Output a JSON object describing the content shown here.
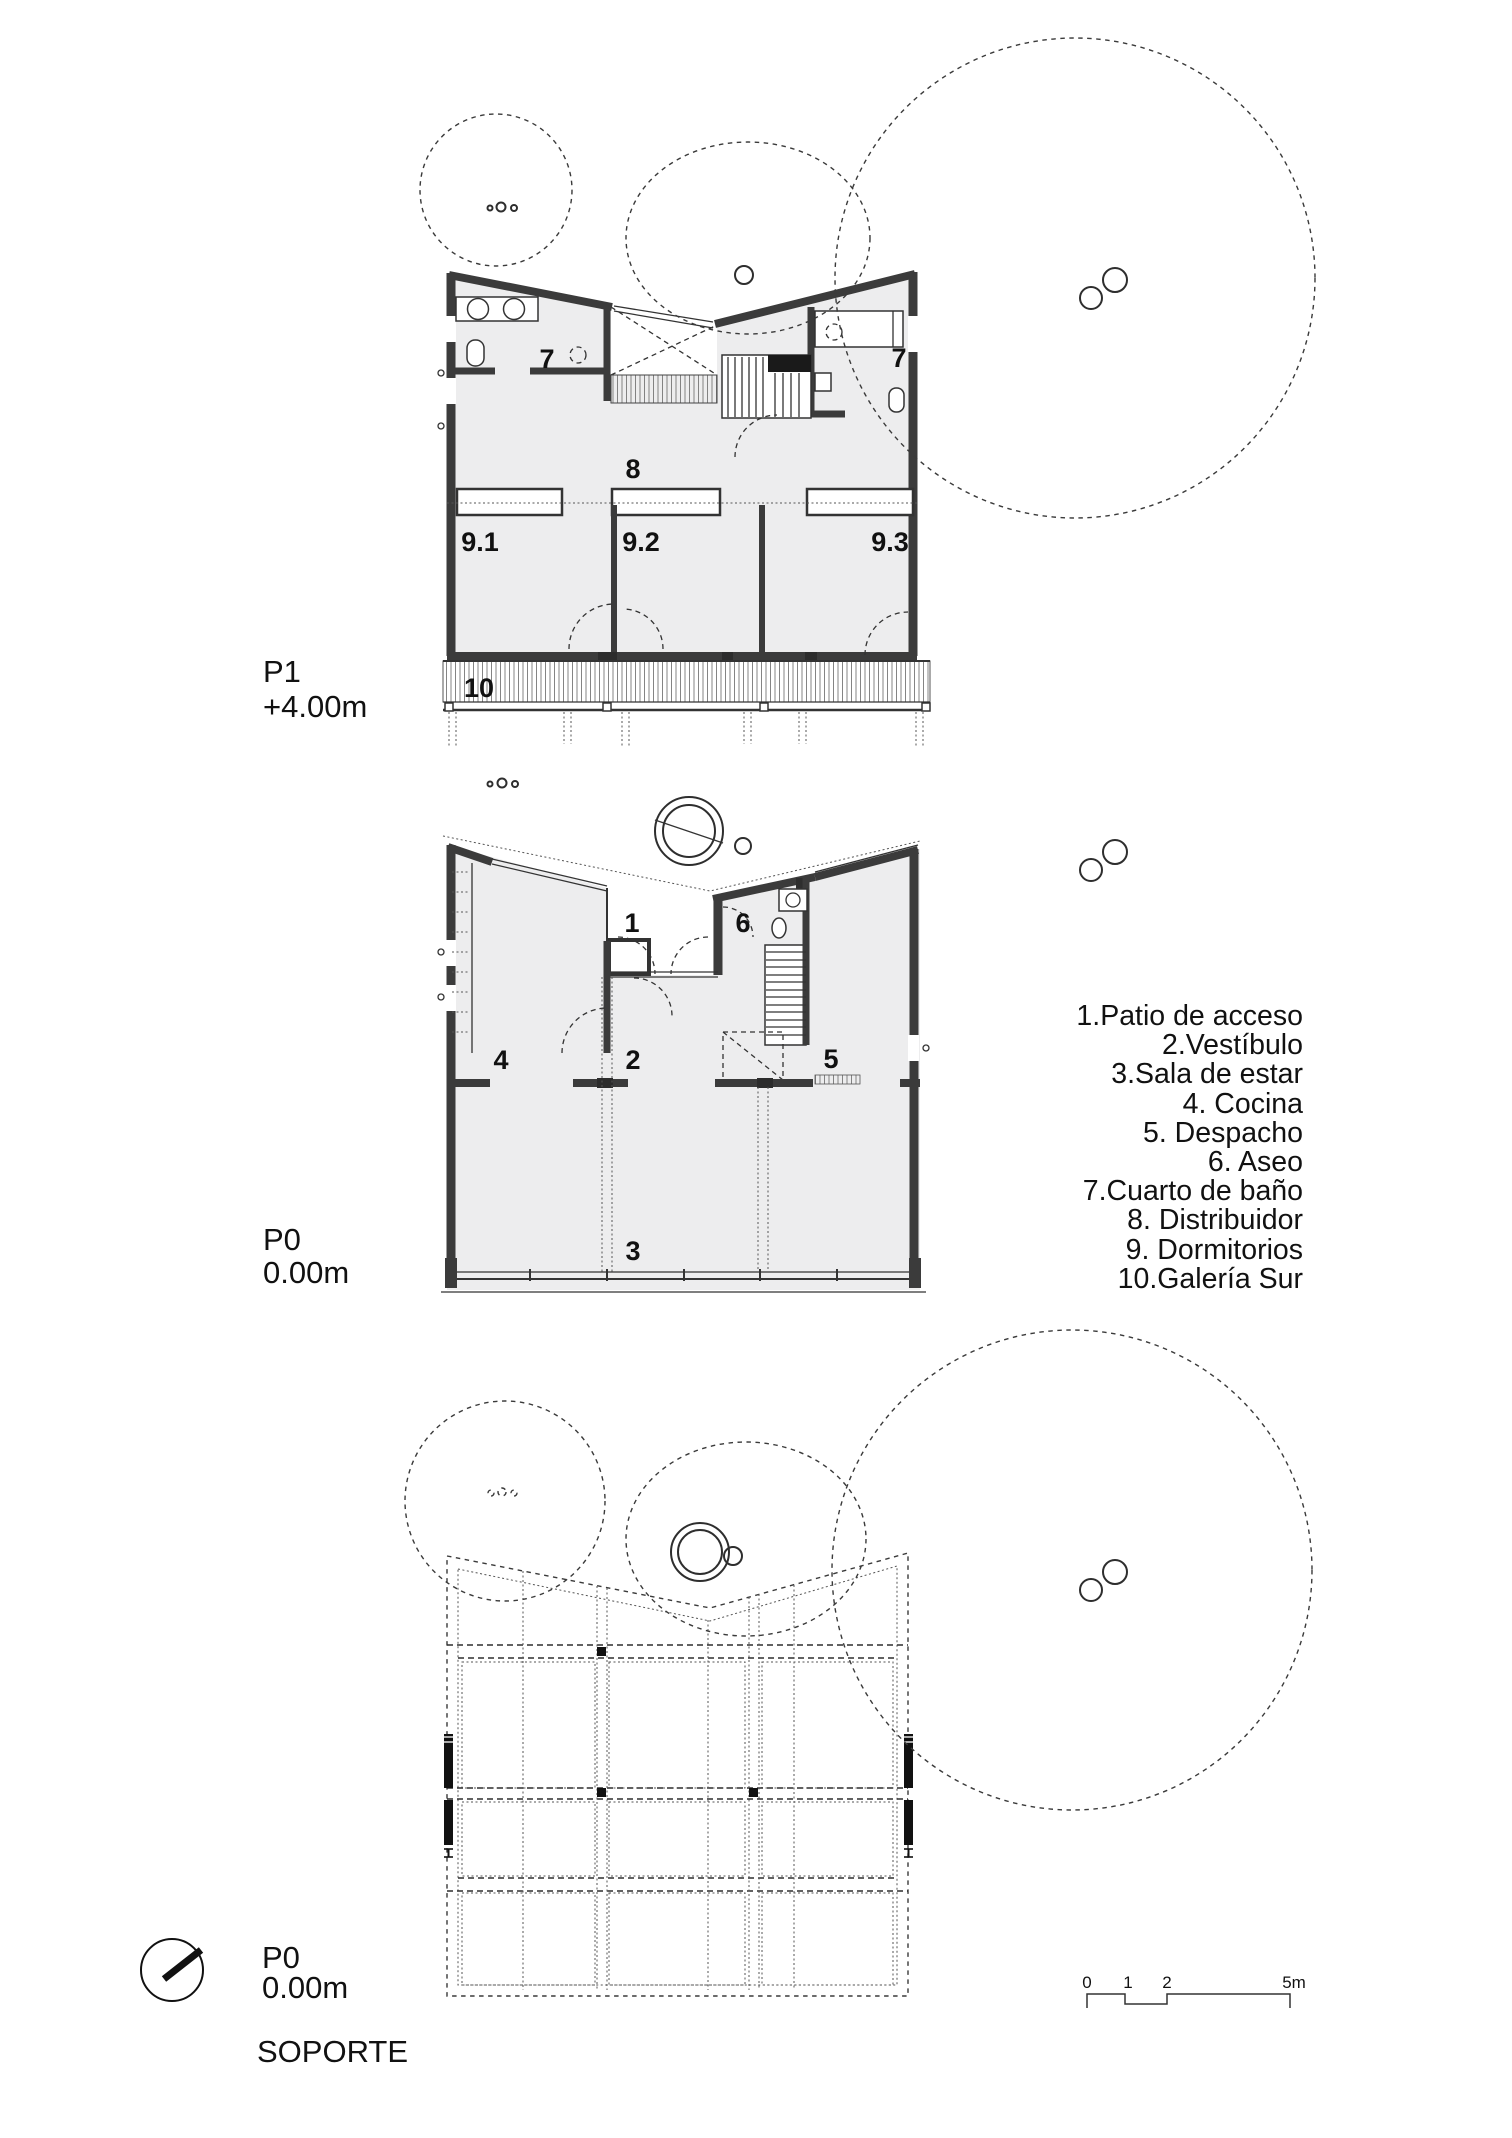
{
  "document": {
    "type": "architectural-floor-plans",
    "colors": {
      "background": "#ffffff",
      "ink": "#1a1a1a",
      "wall": "#3b3b3b",
      "floor_fill": "#ededee",
      "support_fill": "#efefef"
    }
  },
  "plans": {
    "p1": {
      "title": "P1",
      "elevation": "+4.00m",
      "rooms": {
        "bath_left": "7",
        "bath_right": "7",
        "distribuidor": "8",
        "dormitorio_1": "9.1",
        "dormitorio_2": "9.2",
        "dormitorio_3": "9.3",
        "galeria": "10"
      }
    },
    "p0": {
      "title": "P0",
      "elevation": "0.00m",
      "rooms": {
        "patio": "1",
        "vestibulo": "2",
        "sala": "3",
        "cocina": "4",
        "despacho": "5",
        "aseo": "6"
      }
    },
    "soporte": {
      "title": "P0",
      "elevation": "0.00m",
      "caption": "SOPORTE"
    }
  },
  "legend": {
    "items": [
      "1.Patio de acceso",
      "2.Vestíbulo",
      "3.Sala de estar",
      "4. Cocina",
      "5. Despacho",
      "6. Aseo",
      "7.Cuarto de baño",
      "8. Distribuidor",
      "9. Dormitorios",
      "10.Galería Sur"
    ]
  },
  "scale_bar": {
    "labels": [
      "0",
      "1",
      "2",
      "5m"
    ]
  }
}
